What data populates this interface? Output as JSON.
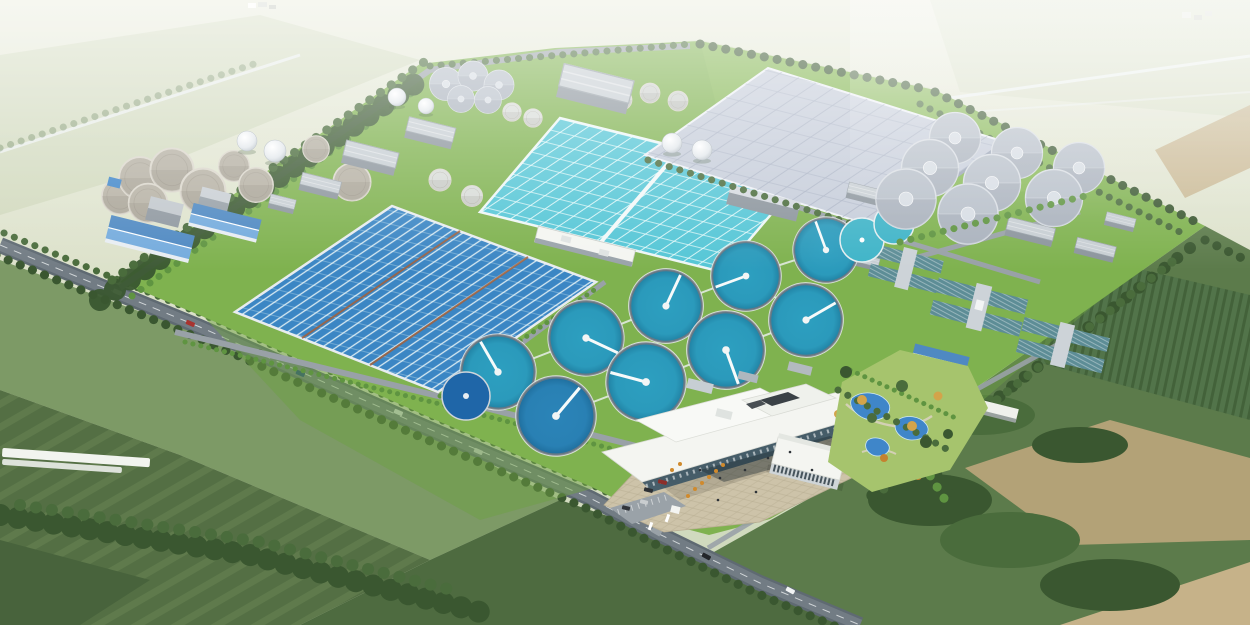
{
  "meta": {
    "title": "Aerial rendering of a wastewater treatment plant campus in rural farmland",
    "type": "3d-architectural-rendering",
    "view": "aerial-oblique, looking north, hazy horizon",
    "description": "Bird's-eye rendering of a large sewage treatment works: serpentine oxidation-ditch basin, gridded aeration basins, circular clarifiers with radial scraper bridges, a vast covered treatment hall, digester tanks and gas-holder spheres, filter building complexes, an administration campus with entrance plaza and landscaped garden, all bounded by tree-lined perimeter roads and surrounded by green fields."
  },
  "scene": {
    "areas": [
      {
        "name": "hazy-horizon-fields",
        "description": "Pale misty farmland with faint rural roads at the top of the image"
      },
      {
        "name": "forest-belt-northwest",
        "description": "Dense tree belt along the upper-left site boundary"
      },
      {
        "name": "sludge-tank-cluster",
        "description": "Group of round concrete sludge/thickener tanks at upper left"
      },
      {
        "name": "digester-tanks",
        "description": "Cluster of five gray anaerobic digester tanks at top center"
      },
      {
        "name": "gas-holder-spheres",
        "description": "White spherical gas holders scattered near the digesters"
      },
      {
        "name": "white-storage-tanks",
        "description": "Small white cylindrical storage tanks"
      },
      {
        "name": "blue-roof-buildings",
        "description": "Industrial workshops with pitched blue metal roofs on the west side"
      },
      {
        "name": "industrial-buildings",
        "description": "Flat-roofed gray process buildings across the upper site"
      },
      {
        "name": "oxidation-ditch-basin",
        "description": "Large deep-blue serpentine oxidation ditch basin with white lane walls, west-center"
      },
      {
        "name": "aeration-basin",
        "description": "Turquoise fine-gridded aeration basin, upper center"
      },
      {
        "name": "covered-treatment-hall",
        "description": "Very large pale paneled roof covering basins, upper right"
      },
      {
        "name": "clarifier-field",
        "description": "Nine circular secondary clarifiers with white radial bridges, center"
      },
      {
        "name": "equalization-ponds",
        "description": "Two deep-blue round storage ponds near the clarifiers"
      },
      {
        "name": "covered-clarifier-cluster",
        "description": "Eight gray covered circular tanks, east side"
      },
      {
        "name": "filter-complexes",
        "description": "Cross-shaped filter building complexes with teal striped roofs, east"
      },
      {
        "name": "admin-building",
        "description": "Modern white flat-roofed administration building with cantilevered roof slab"
      },
      {
        "name": "office-building-2",
        "description": "Second white-roofed office block with glazed facade"
      },
      {
        "name": "entrance-plaza",
        "description": "Paved tan plaza with visitors, cars and ornamental trees at the south gate"
      },
      {
        "name": "landscaped-garden",
        "description": "Winding blue ponds, paths and mixed trees east of the admin campus"
      },
      {
        "name": "perimeter-road",
        "description": "Tree-lined gray perimeter road running along the southwest boundary with traffic"
      },
      {
        "name": "plant-gate",
        "description": "Main entrance junction where the perimeter road meets the plaza"
      },
      {
        "name": "surrounding-fields",
        "description": "Dark green crop fields, dirt patches and hedgerows around the site"
      }
    ]
  },
  "counts": {
    "open_clarifiers": 9,
    "covered_tanks": 8,
    "sludge_tanks": 9,
    "digester_tanks": 5,
    "gas_spheres": 6,
    "white_cylinders": 4,
    "aeration_basin_bays": 2,
    "oxidation_ditch_sections": 3,
    "equalization_ponds": 3,
    "blue_roof_buildings": 3,
    "filter_complexes": 3,
    "perimeter_cars": 8
  },
  "colors": {
    "haze-top": "#e7ead9",
    "haze-bottom": "#ccd7ba",
    "far-patch": "#c6d2b0",
    "field-green": "#7d9a66",
    "field-mid": "#68854f",
    "field-dark": "#546f44",
    "field-darker": "#48633c",
    "field-bottom": "#4e6b40",
    "lawn": "#7fb24f",
    "lawn-dark": "#6da044",
    "tree-dark": "#3a5730",
    "tree-mid": "#4a6c3c",
    "tree-bright": "#5f9441",
    "tree-yellow": "#d3a44a",
    "tree-orange": "#c4822f",
    "dirt": "#b3a277",
    "dirt-light": "#c6b289",
    "road": "#5f6a72",
    "road-light": "#99a1a7",
    "road-line": "#eef2f4",
    "water-blue": "#3b86c4",
    "water-teal": "#55c6d6",
    "clarifier": "#2d9fc0",
    "clarifier-deep": "#2b84b8",
    "pond": "#3f86c9",
    "pond-deep": "#1f66a8",
    "lane-white": "#eef8f8",
    "divider-brown": "#a4613a",
    "tank-gray": "#b6b1a4",
    "tank-gray-rim": "#dbd7cc",
    "tank-blue-gray": "#b7bfc9",
    "tank-cap": "#d7dde4",
    "wall-gray": "#c7ced3",
    "roof-gray": "#aeb7be",
    "roof-dark": "#8c959d",
    "roof-blue": "#74abdd",
    "roof-blue-dark": "#4f89c2",
    "roof-teal": "#5d8d96",
    "roof-white": "#f4f5f1",
    "glass-dark": "#3a5464",
    "hall-roof": "#c6cdda",
    "hall-line": "#a9b2c4",
    "plaza": "#cdc3a9",
    "plaza-line": "#b7ac91",
    "path-tan": "#d8d2bd",
    "garden-green": "#a6c46d"
  }
}
